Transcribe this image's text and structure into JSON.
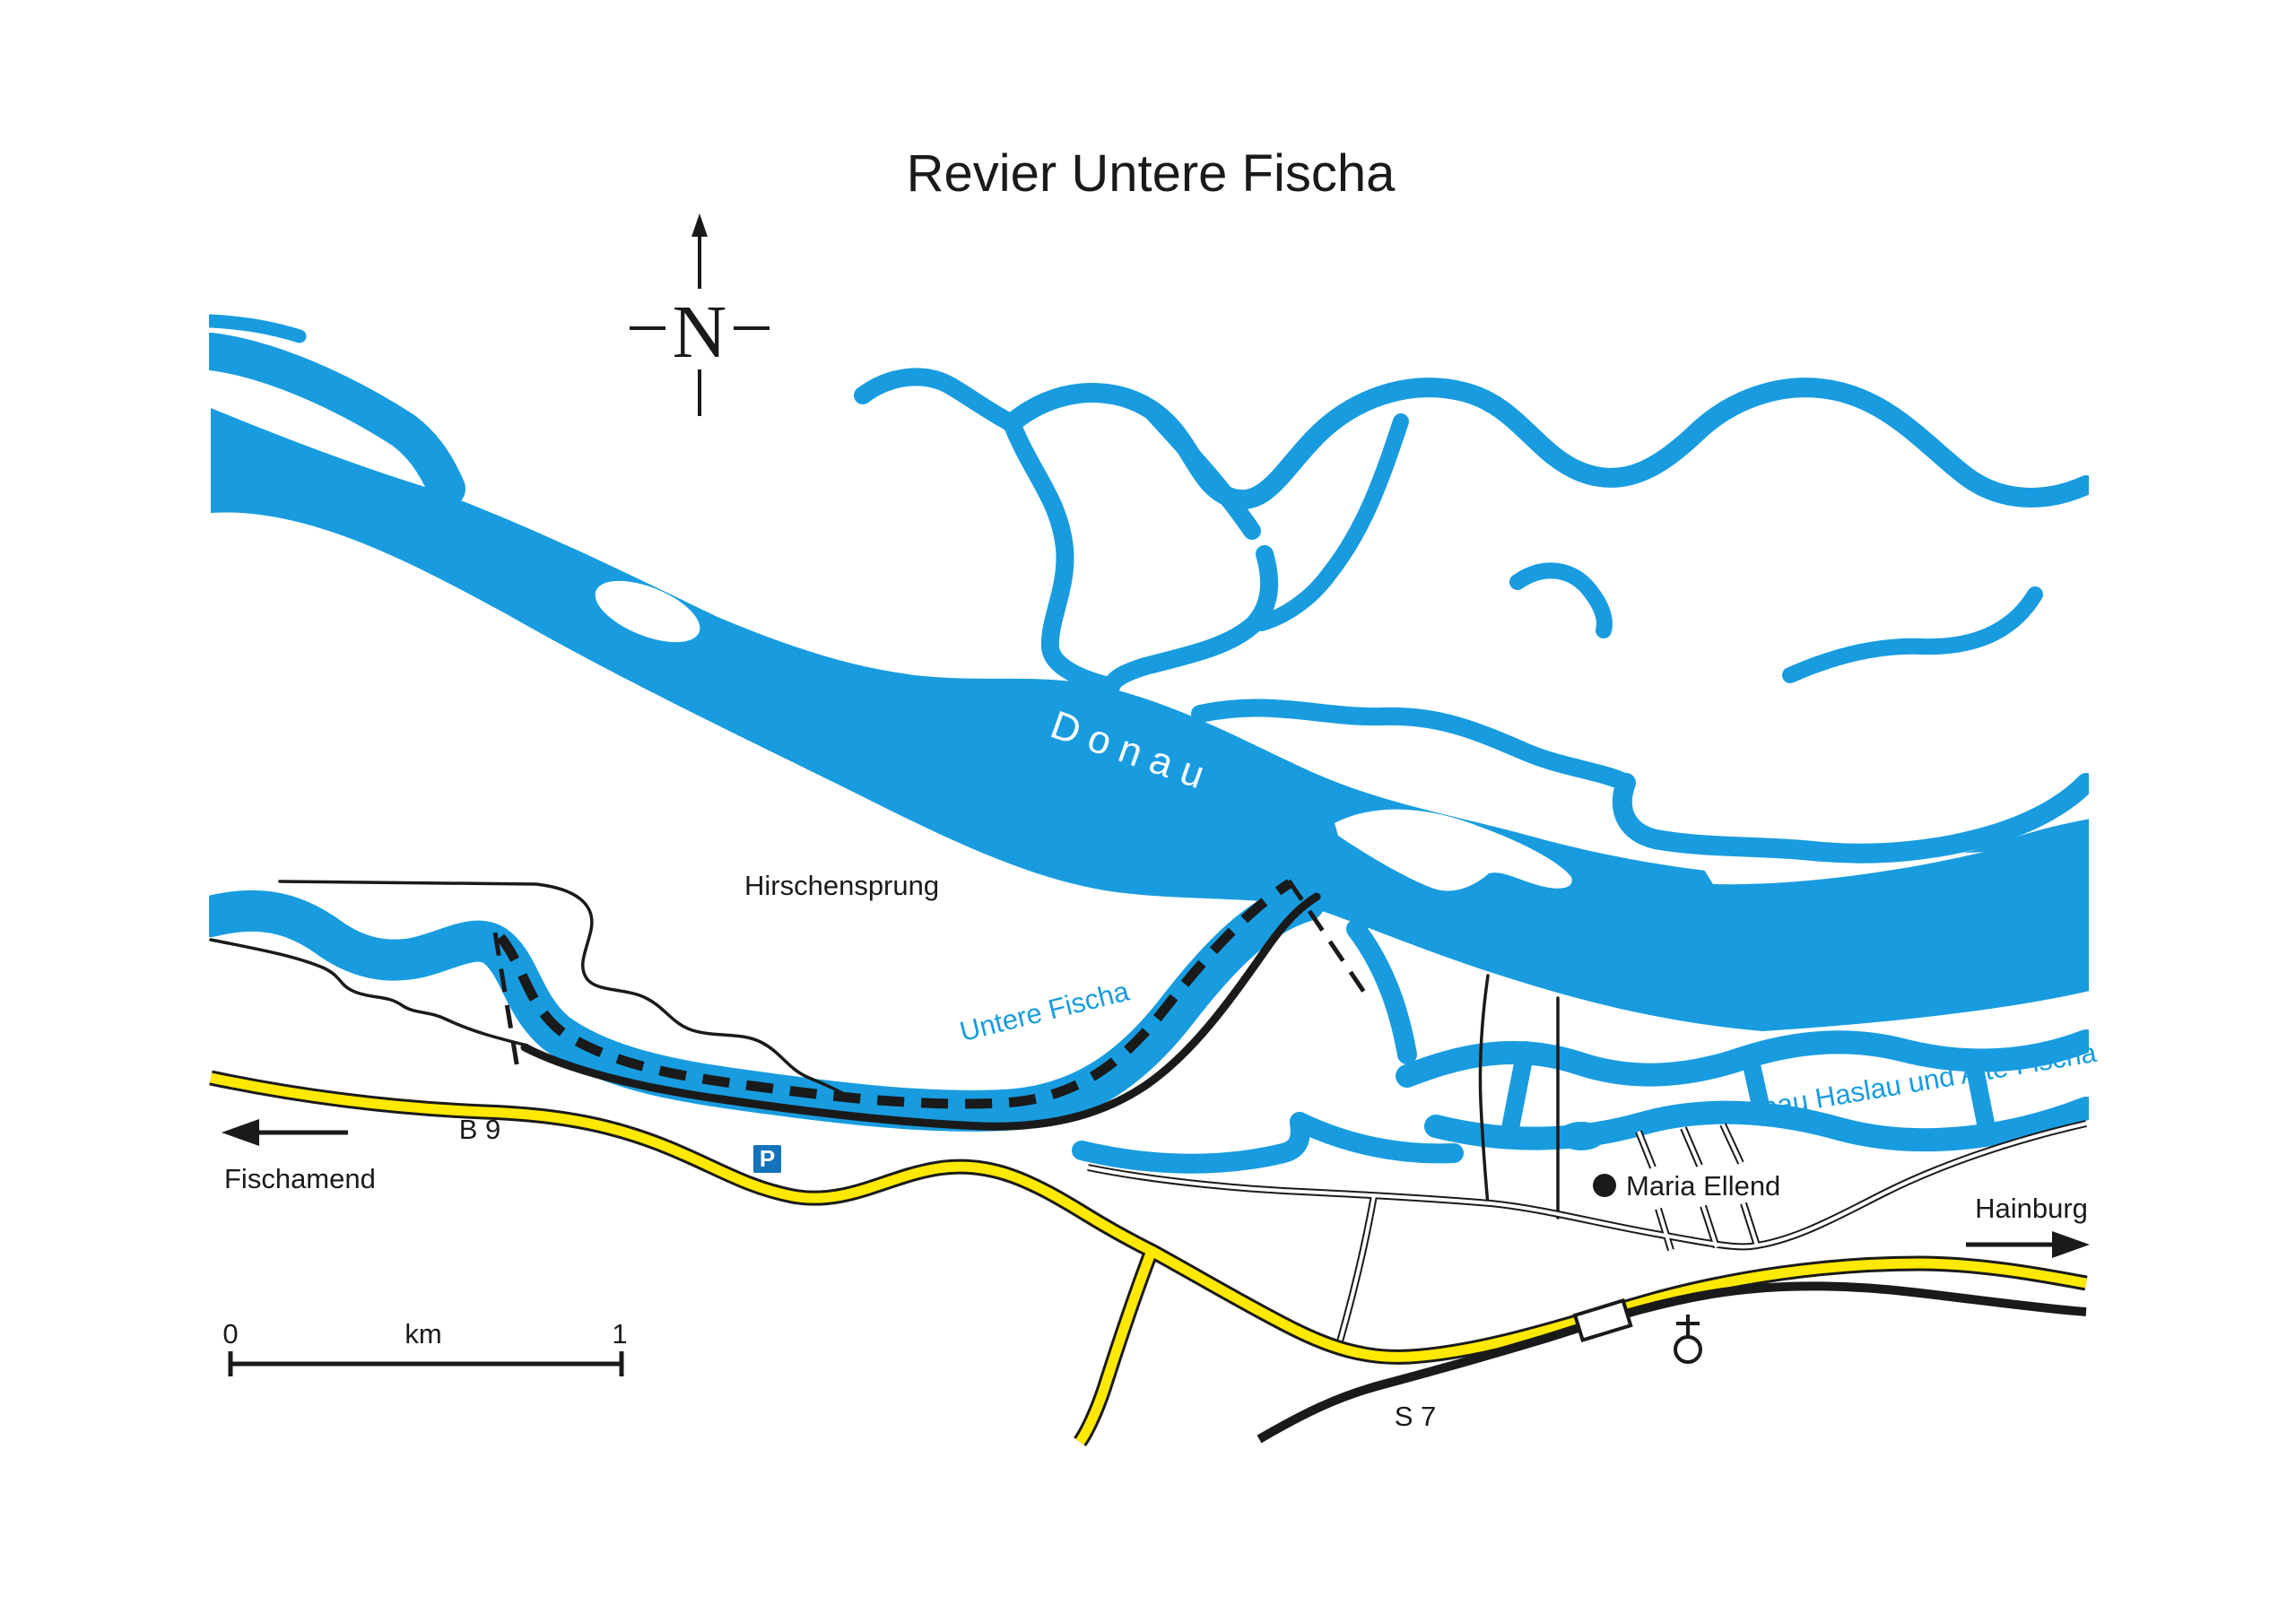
{
  "title": "Revier Untere Fischa",
  "compass": {
    "north_label": "N"
  },
  "waters": {
    "donau_label": "Donau",
    "untere_fischa_label": "Untere Fischa",
    "haslau_label": "Donau Haslau und Alte Fischa"
  },
  "places": {
    "hirschensprung": "Hirschensprung",
    "maria_ellend": "Maria Ellend"
  },
  "directions": {
    "west": "Fischamend",
    "east": "Hainburg"
  },
  "roads": {
    "b9": "B 9",
    "s7": "S 7"
  },
  "symbols": {
    "parking": "P"
  },
  "scale_bar": {
    "start": "0",
    "unit": "km",
    "end": "1"
  },
  "colors": {
    "water": "#189CDF",
    "yellow": "#FFE900",
    "ink": "#1A1A1A",
    "pblue": "#1473BB"
  }
}
